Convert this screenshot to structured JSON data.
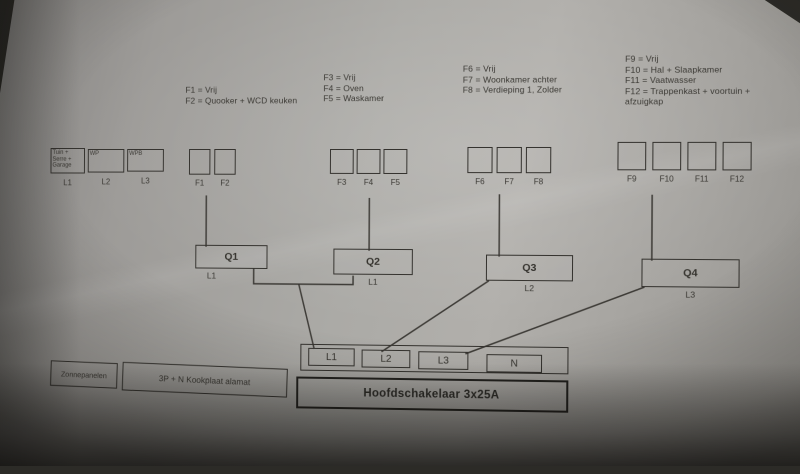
{
  "annotations": [
    {
      "lines": [
        "F1 = Vrij",
        "F2 = Quooker + WCD keuken"
      ]
    },
    {
      "lines": [
        "F3 = Vrij",
        "F4 = Oven",
        "F5 = Waskamer"
      ]
    },
    {
      "lines": [
        "F6 = Vrij",
        "F7 = Woonkamer achter",
        "F8 = Verdieping 1, Zolder"
      ]
    },
    {
      "lines": [
        "F9 = Vrij",
        "F10 = Hal + Slaapkamer",
        "F11 = Vaatwasser",
        "F12 = Trappenkast + voortuin + afzuigkap"
      ]
    }
  ],
  "feeders": [
    {
      "label": "Tuin + Serre + Garage",
      "phase": "L1"
    },
    {
      "label": "WP",
      "phase": "L2"
    },
    {
      "label": "WPB",
      "phase": "L3"
    }
  ],
  "fuse_groups": [
    {
      "fuses": [
        "F1",
        "F2"
      ],
      "breaker": "Q1",
      "phase": "L1"
    },
    {
      "fuses": [
        "F3",
        "F4",
        "F5"
      ],
      "breaker": "Q2",
      "phase": "L1"
    },
    {
      "fuses": [
        "F6",
        "F7",
        "F8"
      ],
      "breaker": "Q3",
      "phase": "L2"
    },
    {
      "fuses": [
        "F9",
        "F10",
        "F11",
        "F12"
      ],
      "breaker": "Q4",
      "phase": "L3"
    }
  ],
  "terminals": [
    "L1",
    "L2",
    "L3",
    "N"
  ],
  "main_switch_label": "Hoofdschakelaar 3x25A",
  "bottom_left_boxes": [
    "Zonnepanelen",
    "3P + N Kookplaat alamat"
  ],
  "colors": {
    "ink": "#34322e",
    "paper_light": "#b1afab",
    "paper_dark": "#868482",
    "background": "#2c2b27"
  }
}
